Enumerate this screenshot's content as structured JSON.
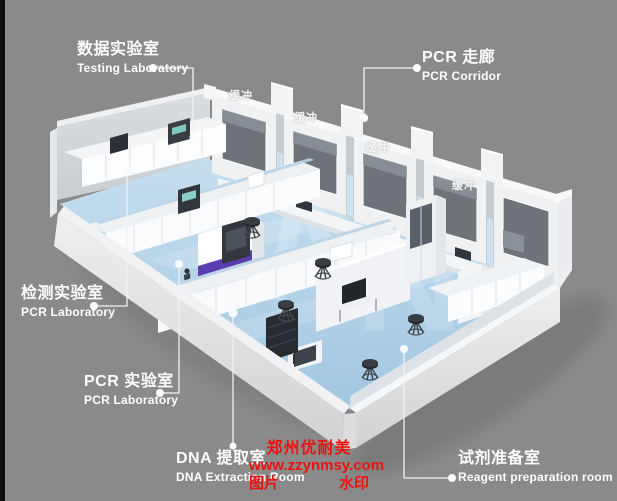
{
  "labels": {
    "testing_lab": {
      "zh": "数据实验室",
      "en": "Testing Laboratory"
    },
    "pcr_corridor": {
      "zh": "PCR 走廊",
      "en": "PCR Corridor"
    },
    "detection_lab": {
      "zh": "检测实验室",
      "en": "PCR Laboratory"
    },
    "pcr_lab": {
      "zh": "PCR 实验室",
      "en": "PCR Laboratory"
    },
    "dna_extraction_room": {
      "zh": "DNA 提取室",
      "en": "DNA Extraction Room"
    },
    "reagent_prep_room": {
      "zh": "试剂准备室",
      "en": "Reagent preparation room"
    },
    "buffer_room": "缓冲"
  },
  "watermark": {
    "line1": "郑州优耐美",
    "line2": "www.zzynmsy.com",
    "left": "图片",
    "right": "水印"
  },
  "colors": {
    "background": "#8a8a8a",
    "left_strip": "#0d0d11",
    "label_text": "#fdfdfd",
    "watermark_red": "#e8150e",
    "floor_blue": "#aecde5",
    "wall_white": "#f2f3f5",
    "window_gray": "#6e737a",
    "accent_purple": "#5a3db0"
  }
}
